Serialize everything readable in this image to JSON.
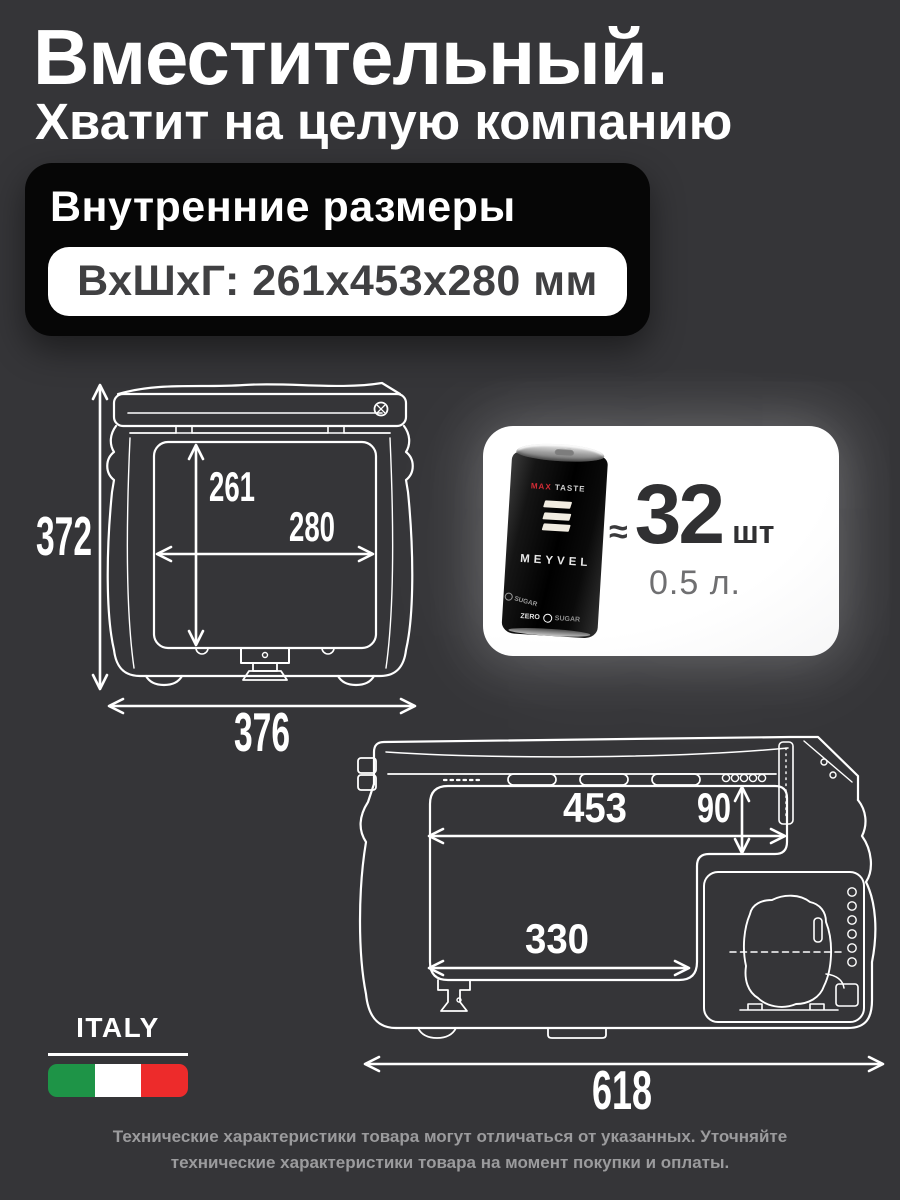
{
  "colors": {
    "background": "#353538",
    "panel_bg": "#060606",
    "line_art": "#ffffff",
    "accent_red": "#d42b35",
    "count_text": "#303032"
  },
  "header": {
    "title": "Вместительный.",
    "subtitle": "Хватит на целую компанию"
  },
  "dimensions_panel": {
    "label": "Внутренние размеры",
    "value": "ВхШхГ: 261x453x280 мм"
  },
  "front_view": {
    "total_height": "372",
    "total_width": "376",
    "inner_height": "261",
    "inner_depth": "280"
  },
  "side_view": {
    "inner_width": "453",
    "step_depth": "90",
    "inner_floor_width": "330",
    "total_length": "618"
  },
  "capacity_card": {
    "approx": "≈",
    "count": "32",
    "count_unit": "шт",
    "can_volume": "0.5 л.",
    "can": {
      "top_line_accent": "MAX",
      "top_line_rest": "TASTE",
      "brand": "MEYVEL",
      "zero": "ZERO",
      "sugar": "SUGAR",
      "side_sugar": "SUGAR"
    }
  },
  "origin": {
    "country": "ITALY",
    "flag": {
      "green": "#1e9447",
      "white": "#ffffff",
      "red": "#ed2b2b"
    }
  },
  "footer": {
    "line1": "Технические характеристики товара могут отличаться от указанных. Уточняйте",
    "line2": "технические характеристики товара на момент покупки и оплаты."
  }
}
